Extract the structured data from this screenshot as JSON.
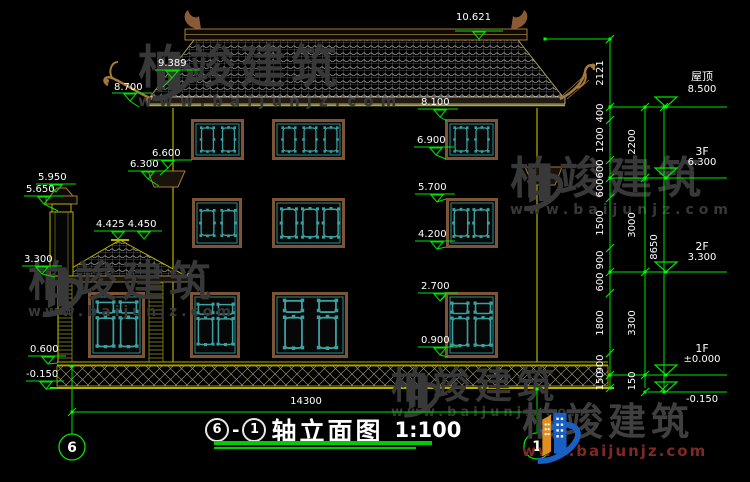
{
  "drawing": {
    "title": {
      "axis_start": "6",
      "axis_end": "1",
      "name": "轴立面图",
      "scale": "1:100",
      "dash": "-"
    },
    "axis_bubbles": {
      "left": "6",
      "right": "1"
    },
    "elevations": {
      "ridge": "10.621",
      "hip": "9.389",
      "eave_tip": "8.700",
      "canopy_top": "6.600",
      "canopy_eave": "6.300",
      "chimney_top": "5.950",
      "chimney_cap": "5.650",
      "wing_ridge": "4.425 4.450",
      "wing_eave": "3.300",
      "plinth": "0.600",
      "ground": "-0.150",
      "win3_top": "8.100",
      "win3_sill": "6.900",
      "win2_top": "5.700",
      "win2_sill": "4.200",
      "win1_top": "2.700",
      "win1_sill": "0.900"
    },
    "dims": {
      "overall_width": "14300",
      "chain_inner": [
        "2121",
        "400",
        "1200",
        "600",
        "600",
        "1500",
        "900",
        "600",
        "1800",
        "900",
        "150"
      ],
      "chain_mid": [
        "2200",
        "3000",
        "3300",
        "150"
      ],
      "chain_outer": [
        "8650"
      ]
    },
    "levels": [
      {
        "floor": "屋顶",
        "value": "8.500"
      },
      {
        "floor": "3F",
        "value": "6.300"
      },
      {
        "floor": "2F",
        "value": "3.300"
      },
      {
        "floor": "1F",
        "value": "±0.000"
      },
      {
        "floor": "",
        "value": "-0.150"
      }
    ]
  },
  "watermark": {
    "brand": "柏竣建筑",
    "url": "www.baijunjz.com"
  },
  "colors": {
    "dim_green": "#00e400",
    "wall_yellow": "#b8b000",
    "frame_brown": "#7d5536",
    "lattice_teal": "#3aa0a0",
    "watermark_gray": "#383838",
    "logo_blue": "#1a5fc2",
    "logo_orange": "#dd8f1f",
    "url_maroon": "#7c2a22"
  }
}
